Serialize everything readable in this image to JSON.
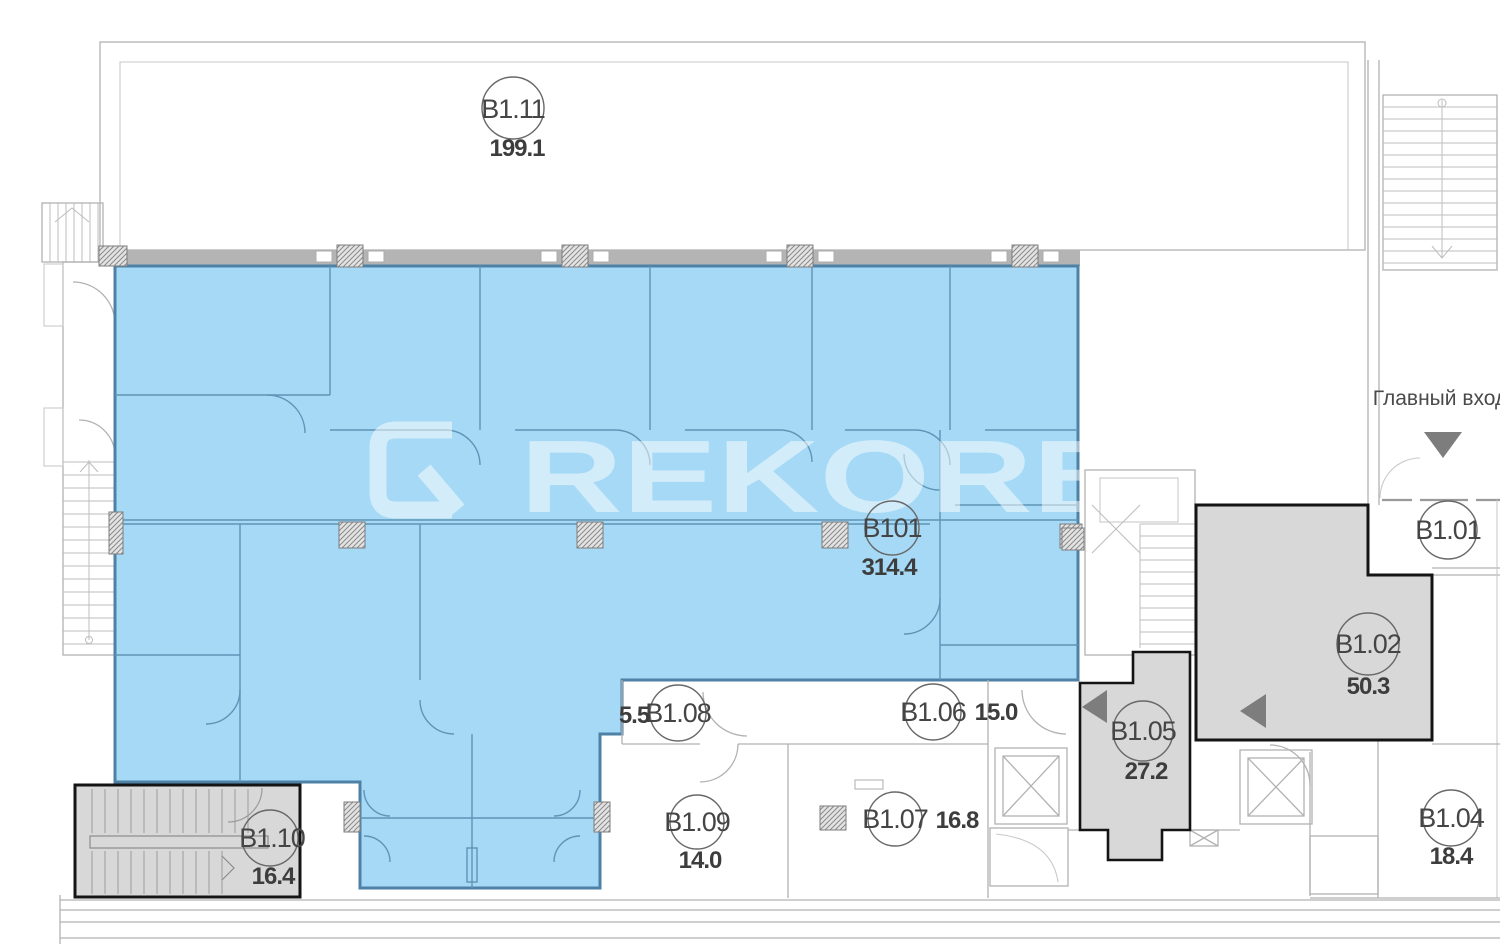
{
  "watermark": "REKORB",
  "entrance": {
    "label": "Главный вход"
  },
  "units": {
    "b111": {
      "code": "B1.11",
      "area": "199.1"
    },
    "b101": {
      "code": "B101",
      "area": "314.4"
    },
    "b101r": {
      "code": "B1.01"
    },
    "b102": {
      "code": "B1.02",
      "area": "50.3"
    },
    "b104": {
      "code": "B1.04",
      "area": "18.4"
    },
    "b105": {
      "code": "B1.05",
      "area": "27.2"
    },
    "b106": {
      "code": "B1.06",
      "area": "15.0"
    },
    "b107": {
      "code": "B1.07",
      "area": "16.8"
    },
    "b108": {
      "code": "B1.08",
      "area": "5.5"
    },
    "b109": {
      "code": "B1.09",
      "area": "14.0"
    },
    "b110": {
      "code": "B1.10",
      "area": "16.4"
    }
  },
  "colors": {
    "highlight_fill": "#a5d9f6",
    "highlight_border": "#4d82a6",
    "unit_gray": "#d8d8d8",
    "arrow_gray": "#7d7d7d"
  }
}
